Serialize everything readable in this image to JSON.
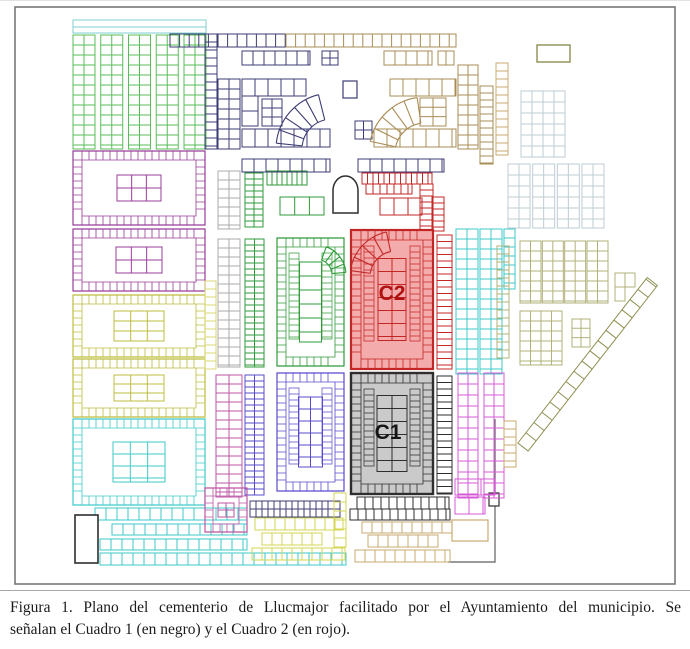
{
  "figure": {
    "caption": {
      "line1": "Figura 1. Plano del cementerio de Llucmajor facilitado por el Ayuntamiento del municipio. Se",
      "line2": "señalan el Cuadro 1 (en negro) y el Cuadro 2 (en rojo)."
    }
  },
  "map": {
    "labels": {
      "cuadro1": "C1",
      "cuadro2": "C2"
    },
    "palette": {
      "wall": "#787878",
      "black": "#2e2e2e",
      "green": "#58bd58",
      "greenDark": "#2f9b39",
      "cyan": "#3fcaca",
      "cyanLight": "#82cfcf",
      "purple": "#9a3d9a",
      "pink": "#bd55a4",
      "magenta": "#d65ad6",
      "yellow": "#bdbd3e",
      "yellowBright": "#d6d650",
      "paleYellow": "#d9d977",
      "navy": "#3c3c74",
      "blue": "#584bcb",
      "tan": "#a98c55",
      "tanLight": "#c9ab72",
      "olive": "#8f8f52",
      "oliveLight": "#b2b27b",
      "paleBlue": "#bfccd6",
      "red": "#c22726",
      "redFill": "#f4abab",
      "redDark": "#b01111",
      "gray": "#ababab",
      "c1Fill": "#cacaca"
    },
    "blocks": [
      {
        "type": "rect",
        "x": 15,
        "y": 6,
        "w": 660,
        "h": 577,
        "color": "wall",
        "sw": 1.6
      },
      {
        "type": "line",
        "pts": [
          [
            495,
            418
          ],
          [
            495,
            561
          ],
          [
            448,
            561
          ]
        ],
        "color": "wall",
        "sw": 1.4
      },
      {
        "type": "rect",
        "x": 489,
        "y": 492,
        "w": 10,
        "h": 13,
        "color": "black",
        "sw": 1.2,
        "fill": "#ffffff"
      },
      {
        "type": "grid",
        "x": 73,
        "y": 19,
        "w": 133,
        "h": 13,
        "ch": 7,
        "color": "cyanLight"
      },
      {
        "type": "strips",
        "x": 73,
        "y": 34,
        "w": 133,
        "h": 114,
        "n": 5,
        "cols": 2,
        "cw": 11,
        "ch": 10,
        "color": "green"
      },
      {
        "type": "ublock",
        "x": 73,
        "y": 150,
        "w": 132,
        "h": 74,
        "t": 9,
        "cgw": 44,
        "cgh": 26,
        "centerCols": 3,
        "cch": 13,
        "color": "purple"
      },
      {
        "type": "ublock",
        "x": 73,
        "y": 228,
        "w": 132,
        "h": 62,
        "t": 9,
        "cgw": 46,
        "cgh": 26,
        "centerCols": 3,
        "cch": 13,
        "color": "purple"
      },
      {
        "type": "ublock",
        "x": 73,
        "y": 294,
        "w": 132,
        "h": 62,
        "t": 9,
        "cgw": 50,
        "cgh": 30,
        "centerCols": 3,
        "cch": 10,
        "color": "yellow"
      },
      {
        "type": "ublock",
        "x": 73,
        "y": 358,
        "w": 132,
        "h": 58,
        "t": 9,
        "cgw": 50,
        "cgh": 26,
        "centerCols": 3,
        "cch": 9,
        "color": "yellow"
      },
      {
        "type": "ublock",
        "x": 73,
        "y": 418,
        "w": 132,
        "h": 86,
        "t": 9,
        "cgw": 52,
        "cgh": 40,
        "centerCols": 3,
        "cch": 12,
        "color": "cyan"
      },
      {
        "type": "grid",
        "x": 95,
        "y": 507,
        "w": 152,
        "h": 12,
        "cw": 11,
        "color": "cyan"
      },
      {
        "type": "grid",
        "x": 112,
        "y": 523,
        "w": 135,
        "h": 11,
        "cw": 11,
        "color": "cyan"
      },
      {
        "type": "grid",
        "x": 100,
        "y": 538,
        "w": 147,
        "h": 11,
        "cw": 11,
        "color": "cyan"
      },
      {
        "type": "grid",
        "x": 100,
        "y": 552,
        "w": 246,
        "h": 12,
        "cw": 11,
        "color": "cyan"
      },
      {
        "type": "rect",
        "x": 75,
        "y": 514,
        "w": 23,
        "h": 48,
        "color": "black",
        "sw": 1.6,
        "fill": "#ffffff"
      },
      {
        "type": "grid",
        "x": 170,
        "y": 33,
        "w": 116,
        "h": 13,
        "cw": 9.6,
        "color": "navy"
      },
      {
        "type": "grid",
        "x": 286,
        "y": 33,
        "w": 170,
        "h": 13,
        "cw": 9.6,
        "color": "tan"
      },
      {
        "type": "grid",
        "x": 242,
        "y": 50,
        "w": 68,
        "h": 14,
        "cw": 11,
        "color": "navy"
      },
      {
        "type": "grid",
        "x": 322,
        "y": 50,
        "w": 16,
        "h": 14,
        "cw": 8,
        "ch": 7,
        "color": "navy"
      },
      {
        "type": "grid",
        "x": 384,
        "y": 50,
        "w": 48,
        "h": 14,
        "cw": 11,
        "color": "tan"
      },
      {
        "type": "grid",
        "x": 438,
        "y": 50,
        "w": 16,
        "h": 14,
        "cw": 8,
        "color": "tan"
      },
      {
        "type": "grid",
        "x": 205,
        "y": 33,
        "w": 12,
        "h": 115,
        "ch": 8,
        "color": "navy"
      },
      {
        "type": "grid",
        "x": 218,
        "y": 78,
        "w": 22,
        "h": 70,
        "cw": 11,
        "ch": 10,
        "color": "navy"
      },
      {
        "type": "grid",
        "x": 242,
        "y": 78,
        "w": 64,
        "h": 17,
        "cw": 13,
        "color": "navy"
      },
      {
        "type": "grid",
        "x": 242,
        "y": 95,
        "w": 16,
        "h": 30,
        "ch": 15,
        "color": "navy"
      },
      {
        "type": "grid",
        "x": 262,
        "y": 98,
        "w": 20,
        "h": 27,
        "cw": 10,
        "ch": 9,
        "color": "navy"
      },
      {
        "type": "grid",
        "x": 242,
        "y": 128,
        "w": 88,
        "h": 18,
        "cw": 13,
        "color": "navy"
      },
      {
        "type": "fan",
        "cx": 332,
        "cy": 148,
        "r1": 30,
        "r2": 56,
        "a1": 186,
        "a2": 256,
        "n": 5,
        "color": "navy"
      },
      {
        "type": "rect",
        "x": 343,
        "y": 80,
        "w": 14,
        "h": 17,
        "color": "navy",
        "sw": 1.2
      },
      {
        "type": "grid",
        "x": 355,
        "y": 120,
        "w": 17,
        "h": 18,
        "cw": 8.5,
        "ch": 9,
        "color": "navy"
      },
      {
        "type": "grid",
        "x": 390,
        "y": 78,
        "w": 66,
        "h": 17,
        "cw": 13,
        "color": "tan"
      },
      {
        "type": "grid",
        "x": 420,
        "y": 97,
        "w": 26,
        "h": 28,
        "cw": 13,
        "ch": 9.3,
        "color": "tan"
      },
      {
        "type": "grid",
        "x": 374,
        "y": 128,
        "w": 82,
        "h": 18,
        "cw": 13,
        "color": "tan"
      },
      {
        "type": "fan",
        "cx": 425,
        "cy": 152,
        "r1": 30,
        "r2": 56,
        "a1": 192,
        "a2": 262,
        "n": 5,
        "color": "tan"
      },
      {
        "type": "grid",
        "x": 458,
        "y": 64,
        "w": 20,
        "h": 84,
        "cw": 10,
        "ch": 10,
        "color": "tan"
      },
      {
        "type": "grid",
        "x": 480,
        "y": 85,
        "w": 13,
        "h": 78,
        "ch": 7,
        "color": "tan"
      },
      {
        "type": "rect",
        "x": 537,
        "y": 44,
        "w": 33,
        "h": 17,
        "color": "olive",
        "sw": 1.4
      },
      {
        "type": "grid",
        "x": 496,
        "y": 62,
        "w": 12,
        "h": 92,
        "ch": 8,
        "color": "tanLight"
      },
      {
        "type": "grid",
        "x": 218,
        "y": 170,
        "w": 22,
        "h": 58,
        "cw": 11,
        "ch": 9,
        "color": "gray"
      },
      {
        "type": "grid",
        "x": 245,
        "y": 172,
        "w": 18,
        "h": 54,
        "cw": 9,
        "ch": 6,
        "color": "greenDark"
      },
      {
        "type": "grid",
        "x": 267,
        "y": 170,
        "w": 40,
        "h": 14,
        "cw": 5,
        "color": "greenDark"
      },
      {
        "type": "grid",
        "x": 280,
        "y": 196,
        "w": 44,
        "h": 18,
        "cw": 14.7,
        "color": "greenDark"
      },
      {
        "type": "grid",
        "x": 242,
        "y": 158,
        "w": 88,
        "h": 13,
        "cw": 12,
        "color": "navy"
      },
      {
        "type": "arch",
        "x": 333,
        "y": 177,
        "w": 25,
        "h": 35,
        "color": "black"
      },
      {
        "type": "grid",
        "x": 358,
        "y": 158,
        "w": 86,
        "h": 13,
        "cw": 12,
        "color": "navy"
      },
      {
        "type": "grid",
        "x": 362,
        "y": 172,
        "w": 70,
        "h": 11,
        "cw": 5.5,
        "color": "red"
      },
      {
        "type": "grid",
        "x": 366,
        "y": 183,
        "w": 46,
        "h": 10,
        "cw": 7,
        "color": "red"
      },
      {
        "type": "grid",
        "x": 380,
        "y": 197,
        "w": 42,
        "h": 17,
        "cw": 14,
        "color": "red"
      },
      {
        "type": "grid",
        "x": 420,
        "y": 183,
        "w": 13,
        "h": 47,
        "ch": 6,
        "color": "red"
      },
      {
        "type": "grid",
        "x": 432,
        "y": 196,
        "w": 12,
        "h": 34,
        "ch": 6,
        "color": "red"
      },
      {
        "type": "grid",
        "x": 205,
        "y": 280,
        "w": 11,
        "h": 88,
        "ch": 8,
        "color": "paleYellow"
      },
      {
        "type": "grid",
        "x": 218,
        "y": 238,
        "w": 22,
        "h": 128,
        "cw": 11,
        "ch": 9,
        "color": "gray"
      },
      {
        "type": "grid",
        "x": 245,
        "y": 238,
        "w": 19,
        "h": 128,
        "cw": 9.5,
        "ch": 6,
        "color": "greenDark"
      },
      {
        "type": "ublock",
        "x": 277,
        "y": 237,
        "w": 67,
        "h": 128,
        "t": 9,
        "cgw": 22,
        "cgh": 80,
        "centerCols": 1,
        "cch": 14,
        "ring2": true,
        "color": "greenDark"
      },
      {
        "type": "fan",
        "cx": 316,
        "cy": 274,
        "r1": 16,
        "r2": 30,
        "a1": 290,
        "a2": 355,
        "n": 4,
        "color": "greenDark"
      },
      {
        "type": "ublock",
        "x": 351,
        "y": 229,
        "w": 82,
        "h": 139,
        "t": 10,
        "cgw": 28,
        "cgh": 82,
        "centerCols": 2,
        "cch": 13,
        "ring2": true,
        "color": "red",
        "fill": "redFill",
        "sw": 2.2,
        "labelRef": "cuadro2",
        "labelColor": "redDark",
        "labelX": 392,
        "labelY": 299,
        "labelSize": 21
      },
      {
        "type": "fan",
        "cx": 396,
        "cy": 276,
        "r1": 26,
        "r2": 46,
        "a1": 188,
        "a2": 258,
        "n": 4,
        "color": "red"
      },
      {
        "type": "grid",
        "x": 437,
        "y": 234,
        "w": 15,
        "h": 134,
        "ch": 6.5,
        "color": "red"
      },
      {
        "type": "strips",
        "x": 456,
        "y": 228,
        "w": 46,
        "h": 145,
        "n": 2,
        "cols": 2,
        "cw": 11,
        "ch": 10,
        "color": "cyan"
      },
      {
        "type": "grid",
        "x": 504,
        "y": 228,
        "w": 11,
        "h": 60,
        "ch": 9,
        "color": "cyan"
      },
      {
        "type": "grid",
        "x": 497,
        "y": 245,
        "w": 12,
        "h": 112,
        "ch": 8,
        "color": "oliveLight"
      },
      {
        "type": "strips",
        "x": 521,
        "y": 90,
        "w": 44,
        "h": 66,
        "n": 2,
        "cols": 2,
        "cw": 11,
        "ch": 11,
        "color": "paleBlue"
      },
      {
        "type": "strips",
        "x": 508,
        "y": 163,
        "w": 96,
        "h": 64,
        "n": 4,
        "cols": 2,
        "cw": 11,
        "ch": 11,
        "color": "paleBlue"
      },
      {
        "type": "strips",
        "x": 520,
        "y": 240,
        "w": 88,
        "h": 62,
        "n": 4,
        "cols": 2,
        "cw": 10.5,
        "ch": 10,
        "color": "oliveLight"
      },
      {
        "type": "strips",
        "x": 520,
        "y": 310,
        "w": 42,
        "h": 54,
        "n": 2,
        "cols": 2,
        "cw": 10.5,
        "ch": 10,
        "color": "oliveLight"
      },
      {
        "type": "grid",
        "x": 572,
        "y": 318,
        "w": 18,
        "h": 28,
        "cw": 9,
        "ch": 9.3,
        "color": "oliveLight"
      },
      {
        "type": "grid",
        "x": 615,
        "y": 272,
        "w": 20,
        "h": 14,
        "cw": 10,
        "color": "oliveLight"
      },
      {
        "type": "grid",
        "x": 615,
        "y": 286,
        "w": 10,
        "h": 14,
        "color": "oliveLight"
      },
      {
        "type": "diag",
        "x": 523,
        "y": 446,
        "len": 210,
        "h": 13,
        "cw": 13,
        "angle": -52,
        "color": "olive"
      },
      {
        "type": "grid",
        "x": 216,
        "y": 374,
        "w": 26,
        "h": 122,
        "cw": 13,
        "ch": 9,
        "color": "pink"
      },
      {
        "type": "grid",
        "x": 245,
        "y": 374,
        "w": 19,
        "h": 120,
        "cw": 9.5,
        "ch": 6,
        "color": "blue"
      },
      {
        "type": "ublock",
        "x": 277,
        "y": 372,
        "w": 67,
        "h": 118,
        "t": 9,
        "cgw": 24,
        "cgh": 70,
        "centerCols": 2,
        "cch": 12,
        "ring2": true,
        "color": "blue"
      },
      {
        "type": "ublock",
        "x": 351,
        "y": 372,
        "w": 82,
        "h": 121,
        "t": 10,
        "cgw": 30,
        "cgh": 76,
        "centerCols": 2,
        "cch": 13,
        "ring2": true,
        "color": "black",
        "fill": "c1Fill",
        "sw": 2.4,
        "labelRef": "cuadro1",
        "labelColor": "#161616",
        "labelX": 388,
        "labelY": 438,
        "labelSize": 21
      },
      {
        "type": "grid",
        "x": 437,
        "y": 375,
        "w": 15,
        "h": 118,
        "ch": 6.5,
        "color": "black"
      },
      {
        "type": "strips",
        "x": 458,
        "y": 372,
        "w": 46,
        "h": 125,
        "n": 2,
        "cols": 2,
        "cw": 10,
        "ch": 11,
        "color": "magenta"
      },
      {
        "type": "grid",
        "x": 504,
        "y": 420,
        "w": 12,
        "h": 46,
        "ch": 8,
        "color": "tanLight"
      },
      {
        "type": "grid",
        "x": 455,
        "y": 478,
        "w": 40,
        "h": 16,
        "cw": 13,
        "color": "magenta"
      },
      {
        "type": "grid",
        "x": 455,
        "y": 496,
        "w": 30,
        "h": 17,
        "cw": 14,
        "color": "magenta"
      },
      {
        "type": "ublock",
        "x": 205,
        "y": 487,
        "w": 42,
        "h": 44,
        "t": 8,
        "cgw": 16,
        "cgh": 14,
        "centerCols": 2,
        "cch": 7,
        "color": "pink"
      },
      {
        "type": "grid",
        "x": 250,
        "y": 500,
        "w": 90,
        "h": 16,
        "cw": 6,
        "ch": 8,
        "color": "navy"
      },
      {
        "type": "grid",
        "x": 255,
        "y": 517,
        "w": 88,
        "h": 12,
        "cw": 10,
        "color": "yellowBright"
      },
      {
        "type": "grid",
        "x": 262,
        "y": 532,
        "w": 60,
        "h": 12,
        "cw": 10,
        "color": "yellowBright"
      },
      {
        "type": "grid",
        "x": 252,
        "y": 547,
        "w": 93,
        "h": 12,
        "cw": 10,
        "color": "yellowBright"
      },
      {
        "type": "grid",
        "x": 334,
        "y": 492,
        "w": 12,
        "h": 54,
        "ch": 9,
        "color": "yellowBright"
      },
      {
        "type": "grid",
        "x": 357,
        "y": 496,
        "w": 92,
        "h": 12,
        "cw": 8,
        "color": "black"
      },
      {
        "type": "grid",
        "x": 350,
        "y": 508,
        "w": 100,
        "h": 11,
        "cw": 8,
        "color": "black"
      },
      {
        "type": "grid",
        "x": 362,
        "y": 521,
        "w": 90,
        "h": 11,
        "cw": 10,
        "color": "tanLight"
      },
      {
        "type": "grid",
        "x": 368,
        "y": 534,
        "w": 70,
        "h": 12,
        "cw": 10,
        "color": "tanLight"
      },
      {
        "type": "grid",
        "x": 355,
        "y": 549,
        "w": 95,
        "h": 12,
        "cw": 10,
        "color": "tanLight"
      },
      {
        "type": "rect",
        "x": 452,
        "y": 519,
        "w": 36,
        "h": 21,
        "color": "tanLight",
        "sw": 1.2
      }
    ]
  }
}
